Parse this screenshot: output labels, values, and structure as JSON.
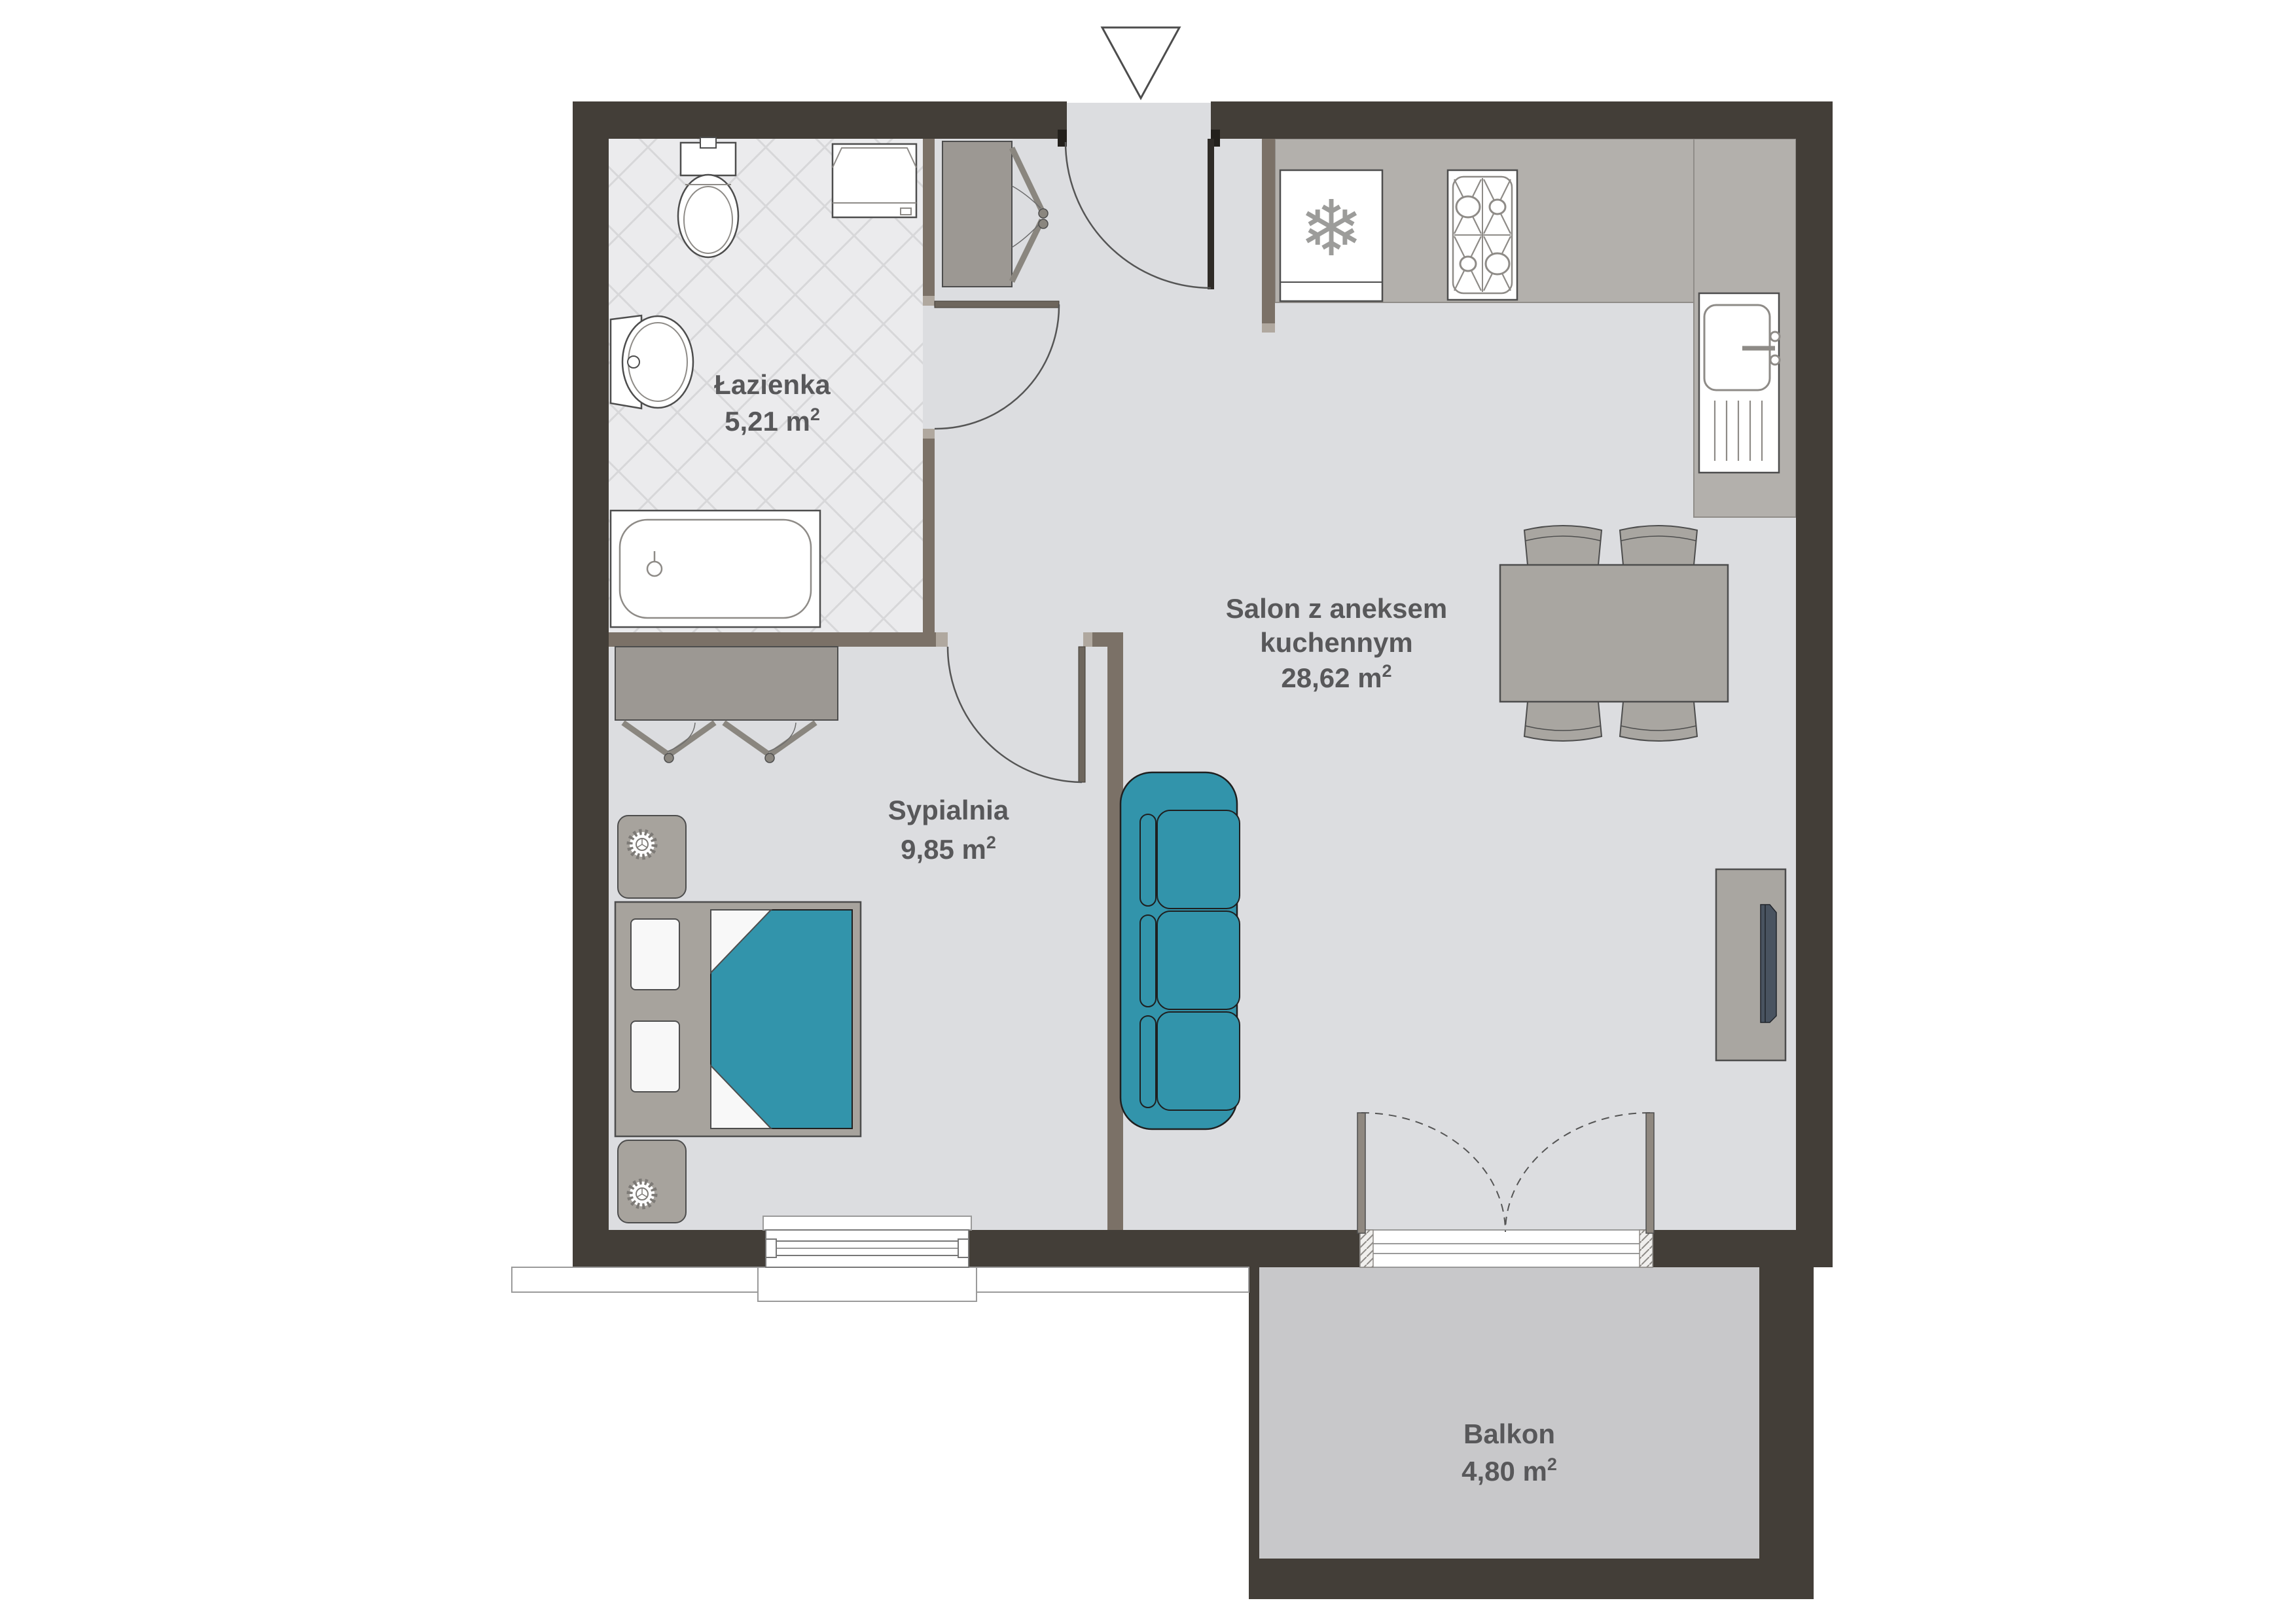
{
  "plan": {
    "rooms": {
      "bathroom": {
        "name": "Łazienka",
        "area_label": "5,21 m",
        "area_sup": "2"
      },
      "bedroom": {
        "name": "Sypialnia",
        "area_label": "9,85 m",
        "area_sup": "2"
      },
      "living": {
        "name_line1": "Salon z aneksem",
        "name_line2": "kuchennym",
        "area_label": "28,62 m",
        "area_sup": "2"
      },
      "balcony": {
        "name": "Balkon",
        "area_label": "4,80 m",
        "area_sup": "2"
      }
    },
    "icons": {
      "snowflake": "❄"
    },
    "colors": {
      "wall": "#433e38",
      "interior_wall": "#7b7167",
      "jamb_cap": "#b0a89f",
      "floor": "#dcdde0",
      "bathroom_floor": "#ebebed",
      "balcony_floor": "#c8c8ca",
      "counter": "#b3b0ac",
      "furniture": "#a9a6a1",
      "cabinet": "#9c9893",
      "bed_frame": "#a7a39d",
      "accent_teal": "#3294ab",
      "tv": "#495360",
      "text": "#58585a",
      "outline": "#4d4d4d"
    }
  }
}
